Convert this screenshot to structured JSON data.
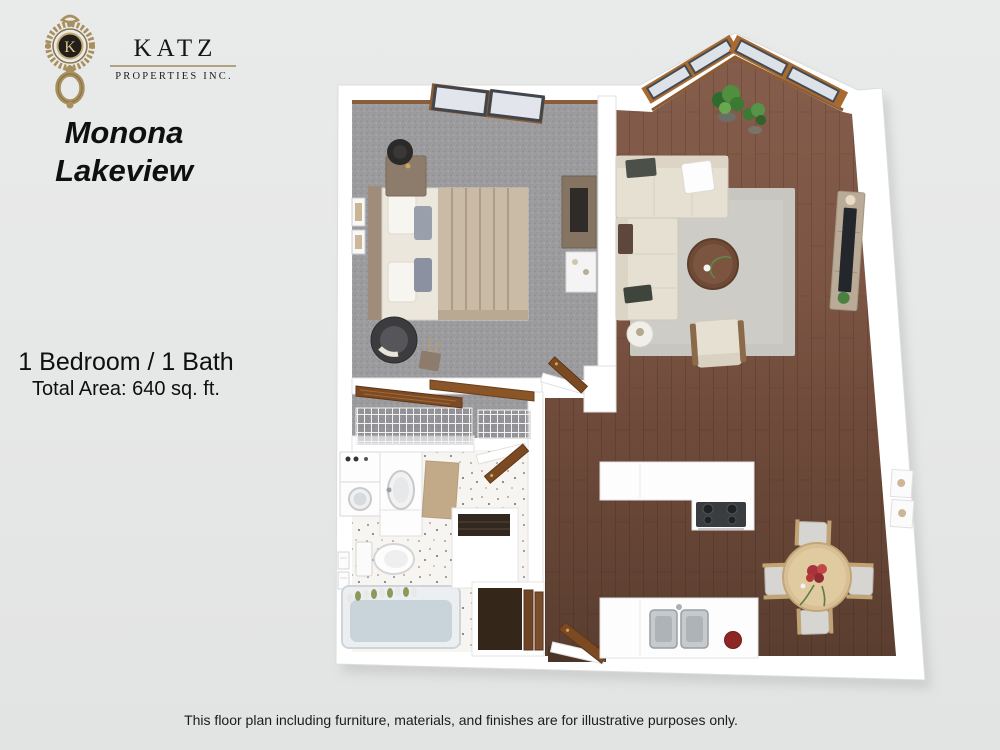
{
  "branding": {
    "monogram": "K",
    "name": "KATZ",
    "subtitle": "PROPERTIES INC.",
    "brand_gold": "#a8905e"
  },
  "title": {
    "line1": "Monona",
    "line2": "Lakeview"
  },
  "details": {
    "configuration": "1 Bedroom / 1 Bath",
    "total_area": "Total Area: 640 sq. ft."
  },
  "footer": {
    "disclaimer": "This floor plan including furniture, materials, and finishes are for illustrative purposes only."
  },
  "floor_plan": {
    "style": "3d-top-down-render",
    "rooms": [
      {
        "name": "bedroom",
        "floor": "gray carpet"
      },
      {
        "name": "living-room",
        "floor": "medium hardwood"
      },
      {
        "name": "kitchen-dining",
        "floor": "dark hardwood"
      },
      {
        "name": "bathroom",
        "floor": "white speckled tile"
      },
      {
        "name": "bedroom-closet",
        "floor": "gray carpet",
        "feature": "wire shelving"
      },
      {
        "name": "entry-hall",
        "floor": "dark hardwood"
      }
    ],
    "colors": {
      "background": "#e6e7e7",
      "walls": "#ffffff",
      "carpet": "#9c9c9f",
      "wood_light": "#855d4c",
      "wood_dark": "#5a3e30",
      "tile": "#f7f5f2",
      "door_wood": "#7b4a22",
      "window_frame": "#a96a2f"
    }
  }
}
